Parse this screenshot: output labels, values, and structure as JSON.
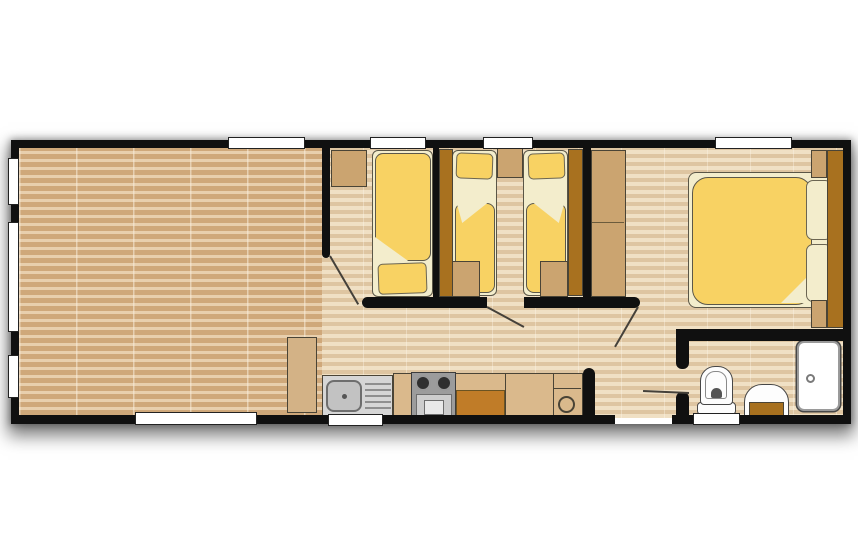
{
  "page": {
    "type": "static-caravan-floor-plan",
    "background": "#ffffff"
  },
  "palette": {
    "wall": "#101010",
    "window": "#ffffff",
    "living_dark": "#cfa87a",
    "living_light": "#e8cfad",
    "hall_dark": "#dec5a1",
    "hall_light": "#f0e0c4",
    "bedding_yellow": "#f8d263",
    "linen_cream": "#f3edcc",
    "tan": "#cba470",
    "dark_brown": "#a8711f",
    "counter": "#dab98c",
    "inset": "#c07c28",
    "appliance": "#cdcdcd",
    "burner": "#2f2f2f"
  },
  "floor_plan": {
    "rooms": [
      {
        "id": "living-area",
        "features": [
          "open-plan",
          "plank-flooring",
          "three-side-windows"
        ]
      },
      {
        "id": "bedroom-single",
        "features": [
          "single-bed",
          "storage-cabinet",
          "top-window"
        ]
      },
      {
        "id": "bedroom-twin",
        "features": [
          "twin-bed-left",
          "twin-bed-right",
          "bedside-cabinet",
          "side-wardrobe-left",
          "side-wardrobe-right",
          "foot-cabinet-left",
          "foot-cabinet-right",
          "top-window"
        ]
      },
      {
        "id": "bedroom-master",
        "features": [
          "double-bed",
          "two-pillows",
          "headboard",
          "nightstand-top",
          "nightstand-bottom",
          "wardrobe-two-section",
          "top-window"
        ]
      },
      {
        "id": "kitchen",
        "features": [
          "tall-cabinet",
          "sink-with-drainer",
          "cooker-two-burners",
          "worktop-with-inset",
          "water-heater-circle",
          "bottom-window"
        ]
      },
      {
        "id": "bathroom",
        "features": [
          "toilet",
          "washbasin-with-vanity",
          "shower-cubicle",
          "bottom-window"
        ]
      },
      {
        "id": "hallway",
        "features": [
          "entrance-opening-bottom-wall"
        ]
      }
    ],
    "doors": [
      {
        "id": "bedroom-single-door",
        "swing": "into-hall"
      },
      {
        "id": "bedroom-twin-door",
        "swing": "into-hall"
      },
      {
        "id": "bedroom-master-door",
        "swing": "into-hall"
      },
      {
        "id": "bathroom-door",
        "swing": "into-hall"
      },
      {
        "id": "entrance-opening",
        "swing": "none"
      }
    ],
    "window_counts": {
      "top": 4,
      "bottom": 3,
      "left": 3,
      "total": 10
    }
  }
}
